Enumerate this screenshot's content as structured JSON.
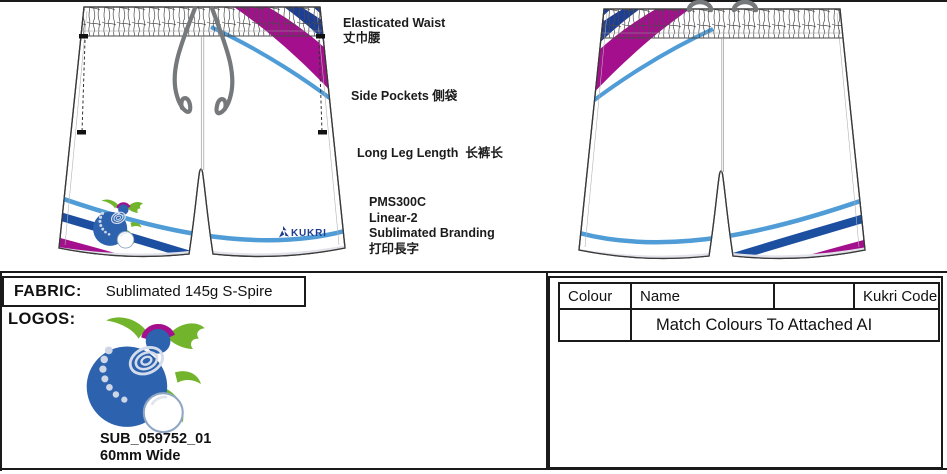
{
  "annotations": {
    "elasticated_waist": {
      "en": "Elasticated Waist",
      "zh": "丈巾腰"
    },
    "side_pockets": "Side Pockets 側袋",
    "long_leg_length": "Long Leg Length  长裤长",
    "branding": {
      "line1": "PMS300C",
      "line2": "Linear-2",
      "line3": "Sublimated Branding",
      "line4": "打印長字"
    }
  },
  "brand": {
    "wordmark": "KUKRI"
  },
  "fabric_panel": {
    "label": "FABRIC:",
    "value": "Sublimated 145g S-Spire"
  },
  "logos_panel": {
    "label": "LOGOS:",
    "artwork_code": "SUB_059752_01",
    "artwork_size": "60mm Wide"
  },
  "colour_table": {
    "col_colour": "Colour",
    "col_name": "Name",
    "col_blank": "",
    "col_kukri_code": "Kukri Code",
    "note": "Match Colours To Attached AI"
  },
  "palette": {
    "magenta": "#a30f8c",
    "navy_stripe": "#1c3e94",
    "blue_stripe": "#1d4fa1",
    "light_blue": "#4f9cd7",
    "bowl_blue": "#2d63ae",
    "leaf_green": "#72b52c",
    "cord_grey": "#75797c",
    "wordmark_navy": "#1c3c8f"
  }
}
